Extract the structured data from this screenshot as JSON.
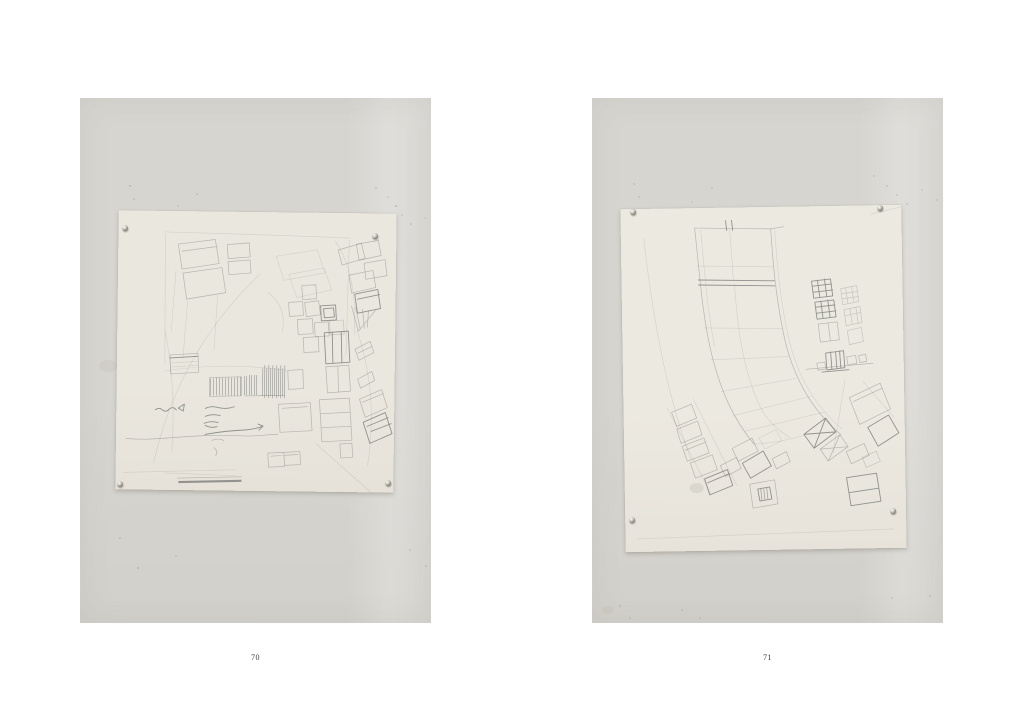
{
  "folios": {
    "left": "70",
    "right": "71"
  },
  "icons": {
    "pushpin": "small-metal-dot"
  },
  "colors": {
    "page_background": "#ffffff",
    "wall": "#d7d5d0",
    "wall_dark": "#d2d0ca",
    "paper": "#eae7df",
    "paper_right": "#ece9e1",
    "pencil": "#8c8c88",
    "pencil_dark": "#6f716f",
    "folio_text": "#3a3a3a"
  }
}
